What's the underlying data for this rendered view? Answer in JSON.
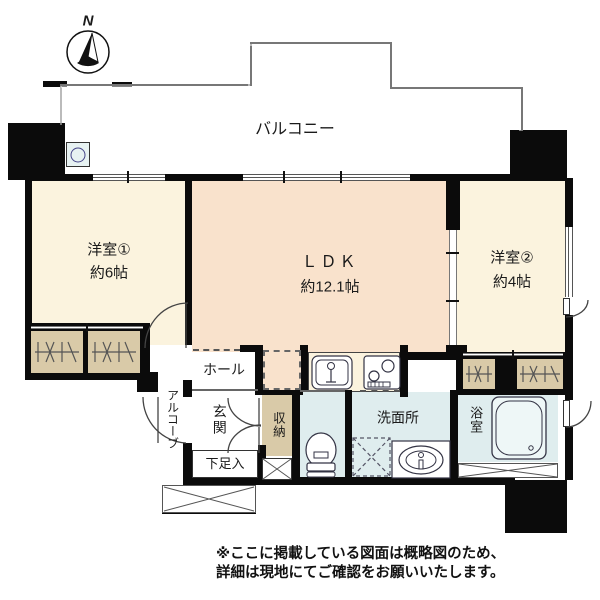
{
  "compass": {
    "label": "N"
  },
  "balcony": {
    "label": "バルコニー"
  },
  "rooms": {
    "room1": {
      "label": "洋室①",
      "size": "約6帖"
    },
    "ldk": {
      "label": "ＬＤＫ",
      "size": "約12.1帖"
    },
    "room2": {
      "label": "洋室②",
      "size": "約4帖"
    },
    "hall": {
      "label": "ホール"
    },
    "entrance": {
      "label": "玄関"
    },
    "storage": {
      "label": "収納"
    },
    "shoe_cabinet": {
      "label": "下足入"
    },
    "washroom": {
      "label": "洗面所"
    },
    "bathroom": {
      "label": "浴室"
    },
    "alcove": {
      "label": "アルコーブ"
    }
  },
  "footer": {
    "line1": "※ここに掲載している図面は概略図のため、",
    "line2": "詳細は現地にてご確認をお願いいたします。"
  },
  "colors": {
    "wall": "#0b0b0b",
    "room_cream": "#fbf3de",
    "ldk_peach": "#f9e2cc",
    "closet_tan": "#d9caa8",
    "wet_blue": "#dfedee"
  }
}
